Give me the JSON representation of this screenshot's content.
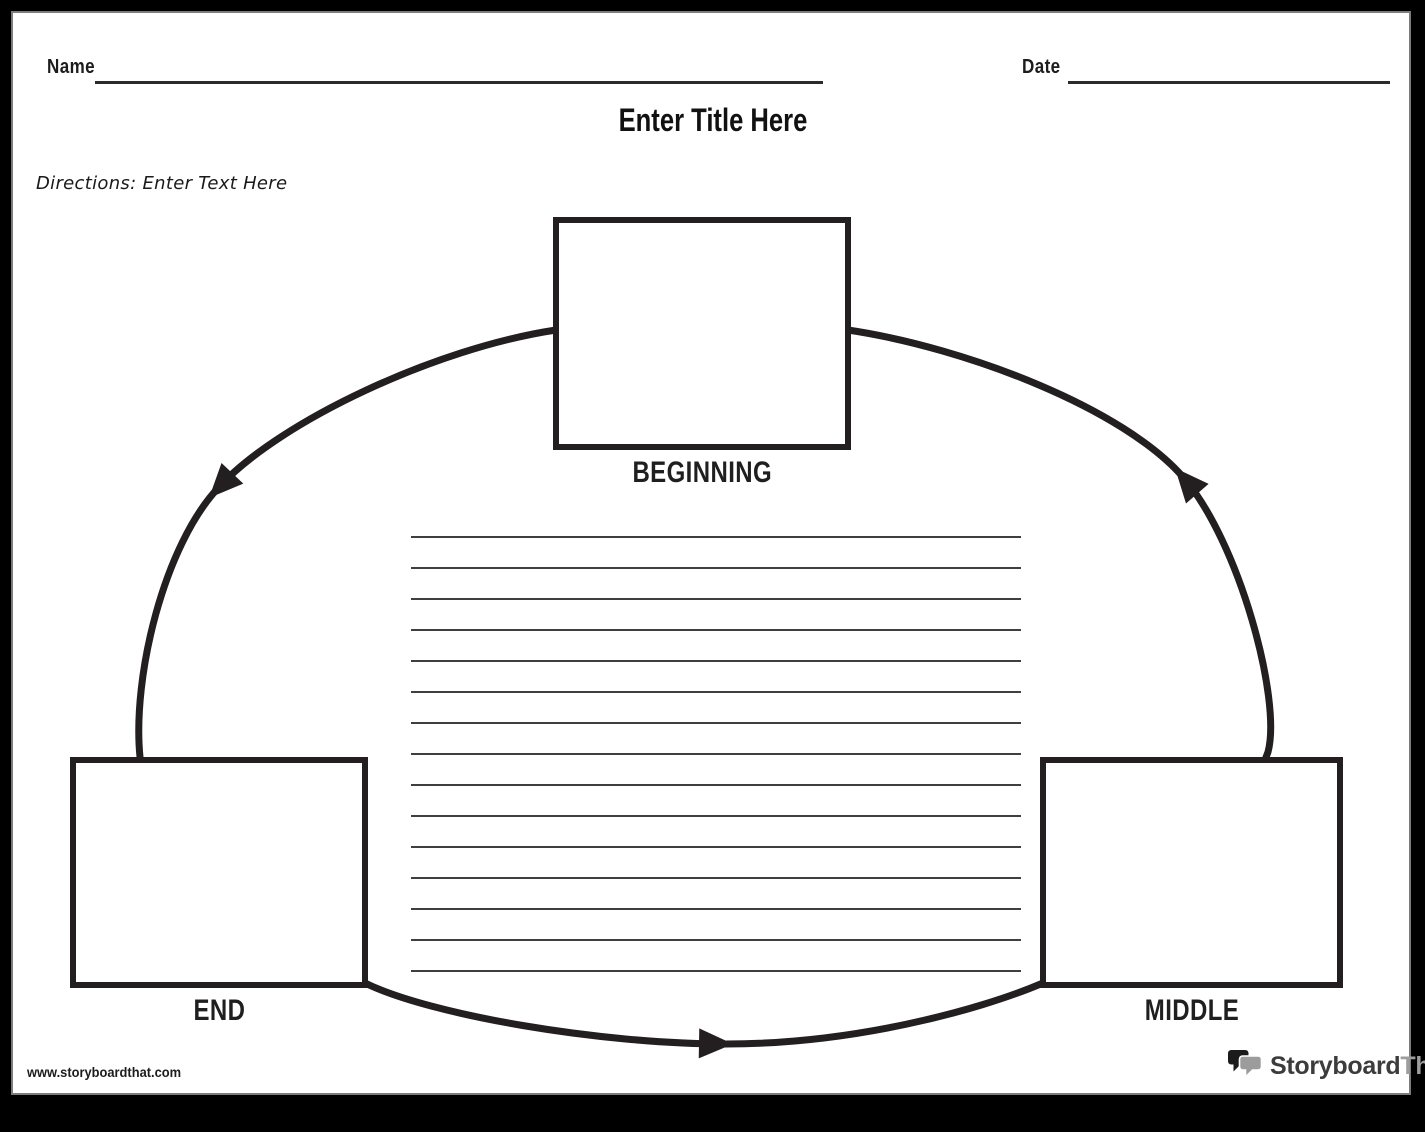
{
  "header": {
    "name_label": "Name",
    "date_label": "Date"
  },
  "title": "Enter Title Here",
  "directions": "Directions: Enter Text Here",
  "diagram": {
    "type": "story-circle-flow",
    "stages": [
      {
        "label": "BEGINNING",
        "position": "top-center"
      },
      {
        "label": "MIDDLE",
        "position": "bottom-right"
      },
      {
        "label": "END",
        "position": "bottom-left"
      }
    ],
    "writing_lines_count": 15
  },
  "footer": {
    "website": "www.storyboardthat.com",
    "logo": {
      "primary": "Storyboard",
      "secondary": "That"
    }
  },
  "colors": {
    "ink": "#231f20",
    "rule_line": "#3f3f3f",
    "logo_secondary": "#9e9e9e",
    "frame": "#000000"
  }
}
